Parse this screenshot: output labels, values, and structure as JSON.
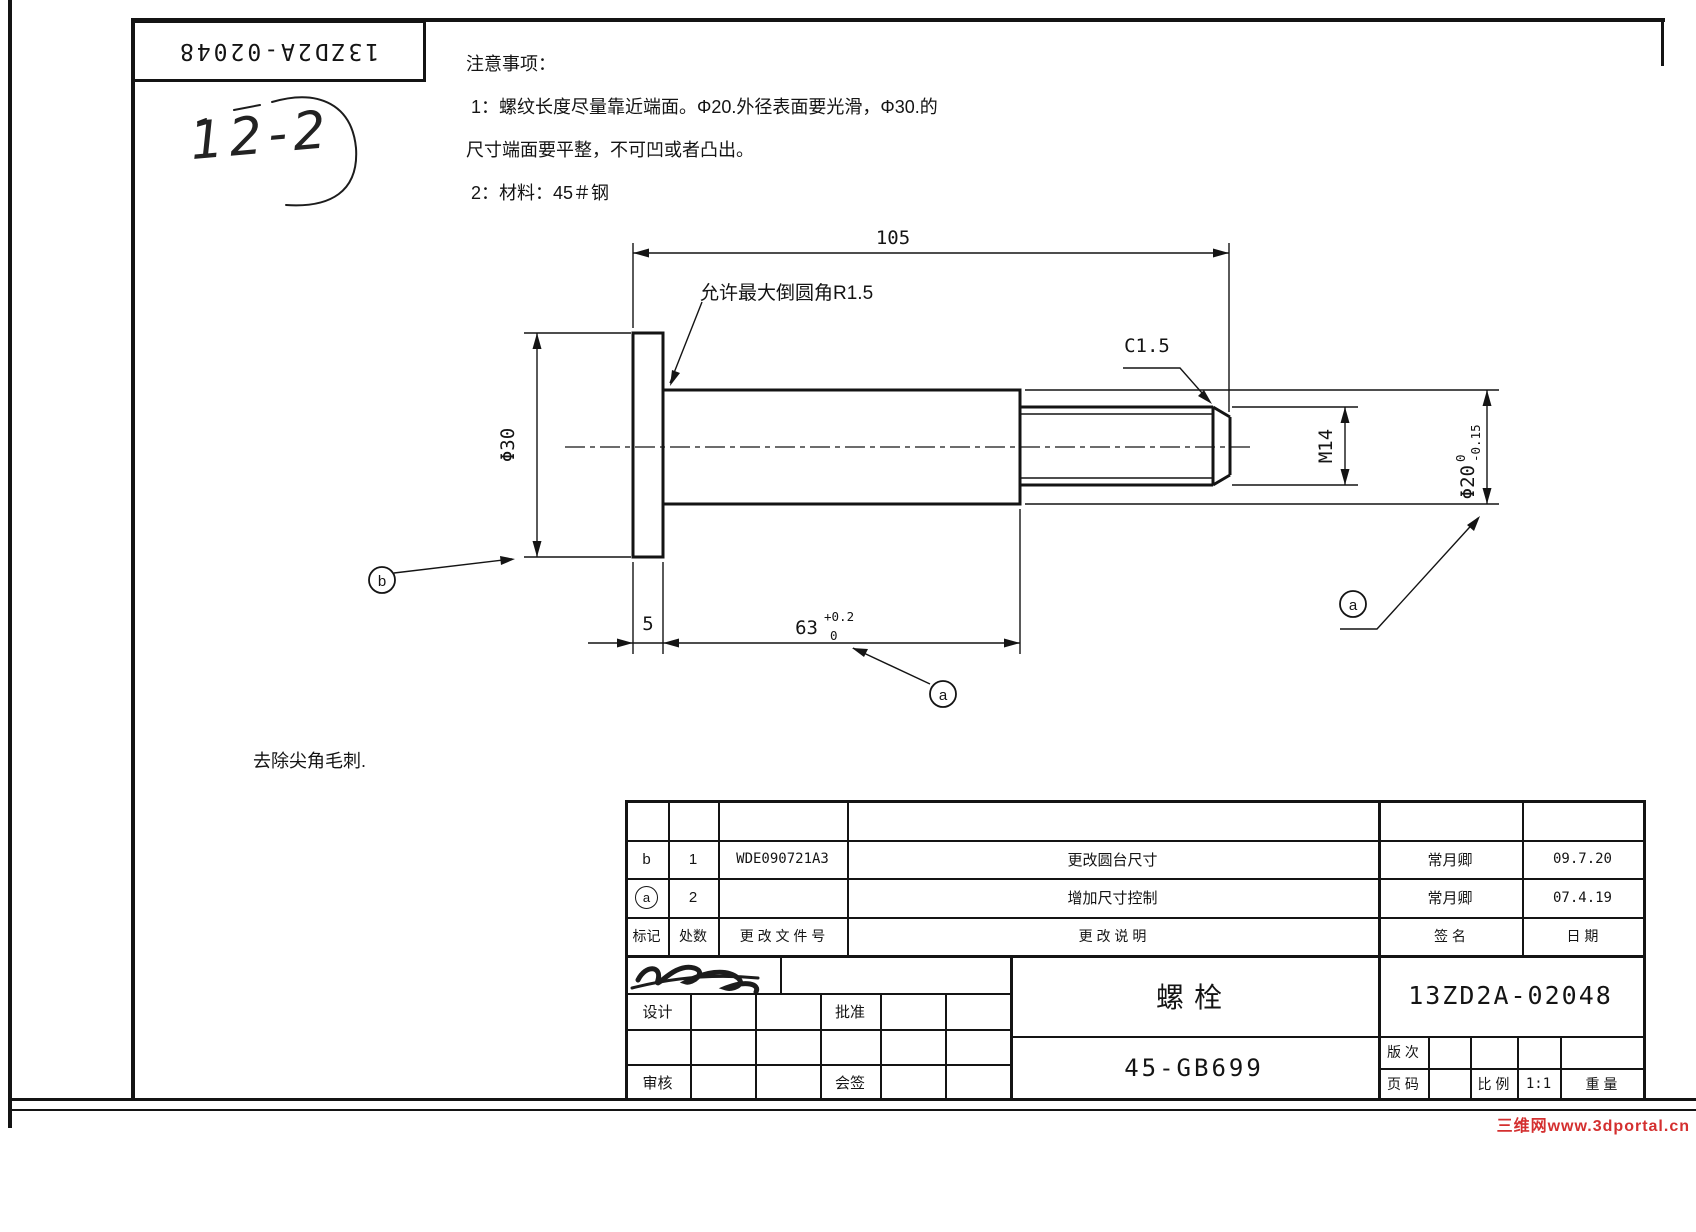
{
  "sheet": {
    "doc_number_box": "13ZD2A-02048",
    "handwritten_mark": "12-2",
    "notes_title": "注意事项：",
    "notes_line1": " 1：螺纹长度尽量靠近端面。Φ20.外径表面要光滑，Φ30.的",
    "notes_line2": "尺寸端面要平整，不可凹或者凸出。",
    "notes_line3": " 2：材料：45＃钢",
    "deburr_note": "去除尖角毛刺.",
    "watermark": "三维网www.3dportal.cn",
    "watermark_color": "#d42f2f",
    "line_color": "#141414"
  },
  "drawing": {
    "dim_overall": "105",
    "fillet_note": "允许最大倒圆角R1.5",
    "chamfer": "C1.5",
    "dim_flange_dia": "Φ30",
    "dim_flange_thk": "5",
    "dim_body_len": "63",
    "dim_body_len_tol_up": "+0.2",
    "dim_body_len_tol_dn": "0",
    "dim_thread": "M14",
    "dim_body_dia": "Φ20",
    "dim_body_dia_tol_up": "0",
    "dim_body_dia_tol_dn": "-0.15",
    "balloon_a": "a",
    "balloon_b": "b"
  },
  "title_block": {
    "rev_rows": [
      {
        "mark": "b",
        "qty": "1",
        "doc": "WDE090721A3",
        "desc": "更改圆台尺寸",
        "sign": "常月卿",
        "date": "09.7.20"
      },
      {
        "mark": "a",
        "qty": "2",
        "doc": "",
        "desc": "增加尺寸控制",
        "sign": "常月卿",
        "date": "07.4.19"
      }
    ],
    "hdr_mark": "标记",
    "hdr_qty": "处数",
    "hdr_doc": "更 改 文 件 号",
    "hdr_desc": "更 改 说 明",
    "hdr_sign": "签 名",
    "hdr_date": "日 期",
    "role_design": "设计",
    "role_approve": "批准",
    "role_check": "审核",
    "role_countersign": "会签",
    "part_name": "螺栓",
    "material_std": "45-GB699",
    "drawing_no": "13ZD2A-02048",
    "lbl_revision": "版 次",
    "lbl_page": "页 码",
    "lbl_scale": "比 例",
    "scale_value": "1:1",
    "lbl_weight": "重 量"
  }
}
